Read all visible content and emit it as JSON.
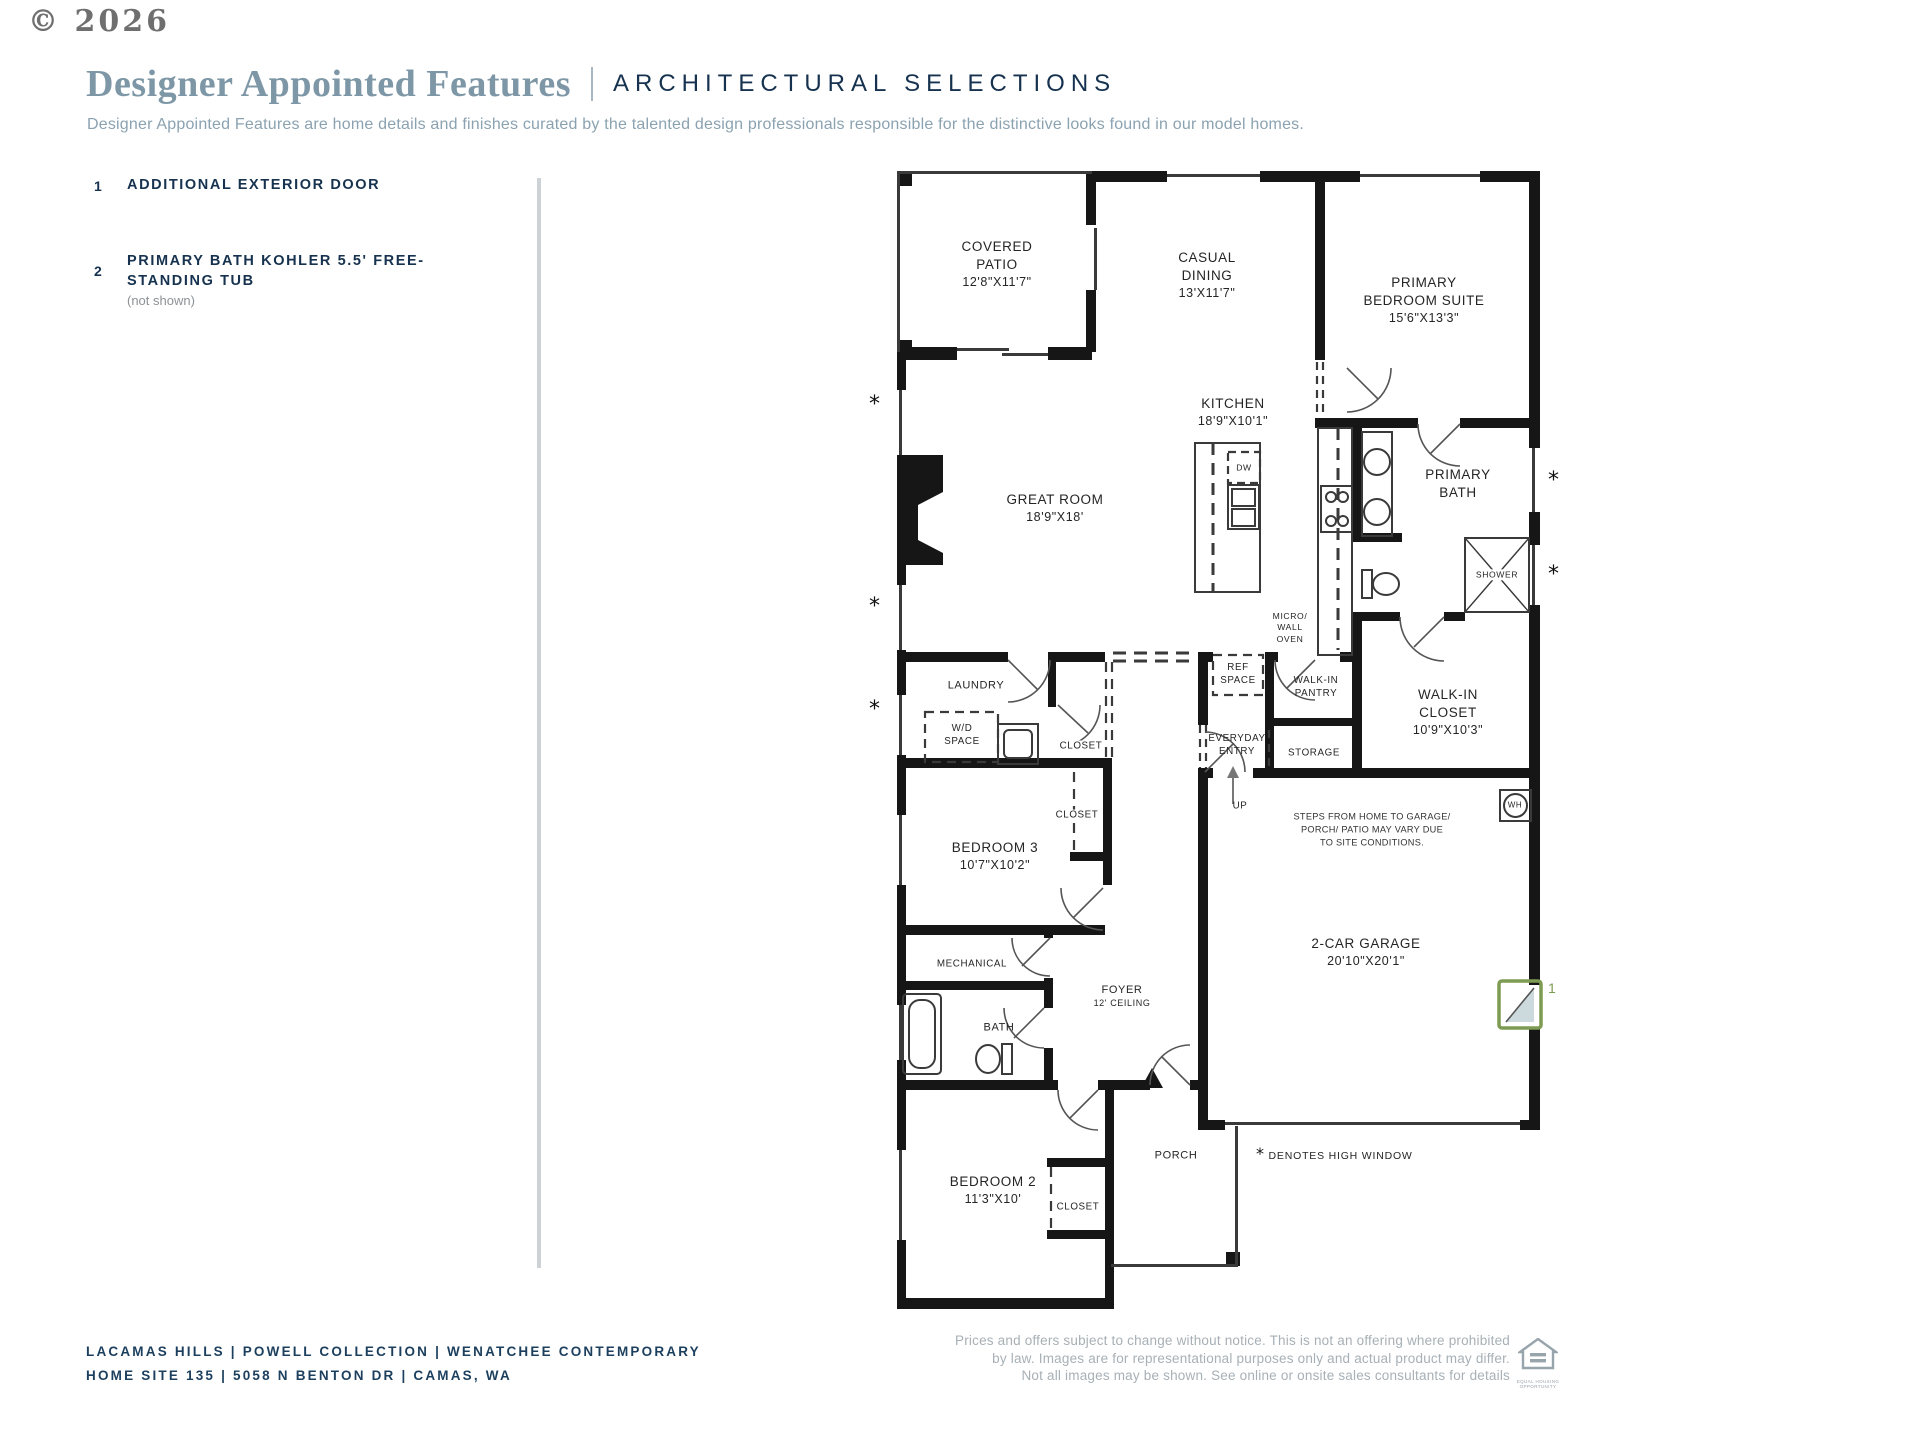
{
  "copyright": "© 2026",
  "header": {
    "title_serif": "Designer Appointed Features",
    "title_caps": "ARCHITECTURAL SELECTIONS",
    "subtitle": "Designer Appointed Features are home details and finishes curated by the talented design professionals responsible for the distinctive looks found in our model homes."
  },
  "features": [
    {
      "num": "1",
      "lines": [
        "ADDITIONAL EXTERIOR DOOR"
      ],
      "note": ""
    },
    {
      "num": "2",
      "lines": [
        "PRIMARY BATH KOHLER 5.5' FREE-",
        "STANDING TUB"
      ],
      "note": "(not shown)"
    }
  ],
  "plan": {
    "high_window_marker": "*",
    "denotes_legend": "DENOTES HIGH WINDOW",
    "marker_1": "1",
    "rooms": {
      "covered_patio": [
        "COVERED",
        "PATIO",
        "12'8\"X11'7\""
      ],
      "casual_dining": [
        "CASUAL",
        "DINING",
        "13'X11'7\""
      ],
      "primary_suite": [
        "PRIMARY",
        "BEDROOM SUITE",
        "15'6\"X13'3\""
      ],
      "kitchen": [
        "KITCHEN",
        "18'9\"X10'1\""
      ],
      "great_room": [
        "GREAT ROOM",
        "18'9\"X18'"
      ],
      "primary_bath": [
        "PRIMARY",
        "BATH"
      ],
      "shower": "SHOWER",
      "dw": "DW",
      "micro": [
        "MICRO/",
        "WALL",
        "OVEN"
      ],
      "ref": [
        "REF",
        "SPACE"
      ],
      "pantry": [
        "WALK-IN",
        "PANTRY"
      ],
      "laundry": "LAUNDRY",
      "wd": [
        "W/D",
        "SPACE"
      ],
      "closet_hall": "CLOSET",
      "everyday": [
        "EVERYDAY",
        "ENTRY"
      ],
      "storage": "STORAGE",
      "wic": [
        "WALK-IN",
        "CLOSET",
        "10'9\"X10'3\""
      ],
      "up": "UP",
      "wh": "WH",
      "steps": [
        "STEPS FROM HOME TO GARAGE/",
        "PORCH/ PATIO MAY VARY DUE",
        "TO SITE CONDITIONS."
      ],
      "closet_b3": "CLOSET",
      "bedroom3": [
        "BEDROOM 3",
        "10'7\"X10'2\""
      ],
      "garage": [
        "2-CAR GARAGE",
        "20'10\"X20'1\""
      ],
      "mechanical": "MECHANICAL",
      "foyer": [
        "FOYER",
        "12' CEILING"
      ],
      "bath": "BATH",
      "bedroom2": [
        "BEDROOM 2",
        "11'3\"X10'"
      ],
      "porch": "PORCH",
      "closet_b2": "CLOSET"
    }
  },
  "footer": {
    "left_line1": "LACAMAS HILLS  |  POWELL COLLECTION  |  WENATCHEE CONTEMPORARY",
    "left_line2": "HOME SITE 135  |  5058 N BENTON DR  |  CAMAS, WA",
    "disclaimer1": "Prices and offers subject to change without notice. This is not an offering where prohibited",
    "disclaimer2": "by law. Images are for representational purposes only and actual product may differ.",
    "disclaimer3": "Not all images may be shown. See online or onsite sales consultants for details",
    "logo_caption": "EQUAL HOUSING OPPORTUNITY"
  },
  "colors": {
    "accent_green": "#7d9b52",
    "navy": "#16324f",
    "title_blue": "#7e97a7",
    "muted_gray": "#a7b0b6",
    "wall_black": "#161616"
  }
}
